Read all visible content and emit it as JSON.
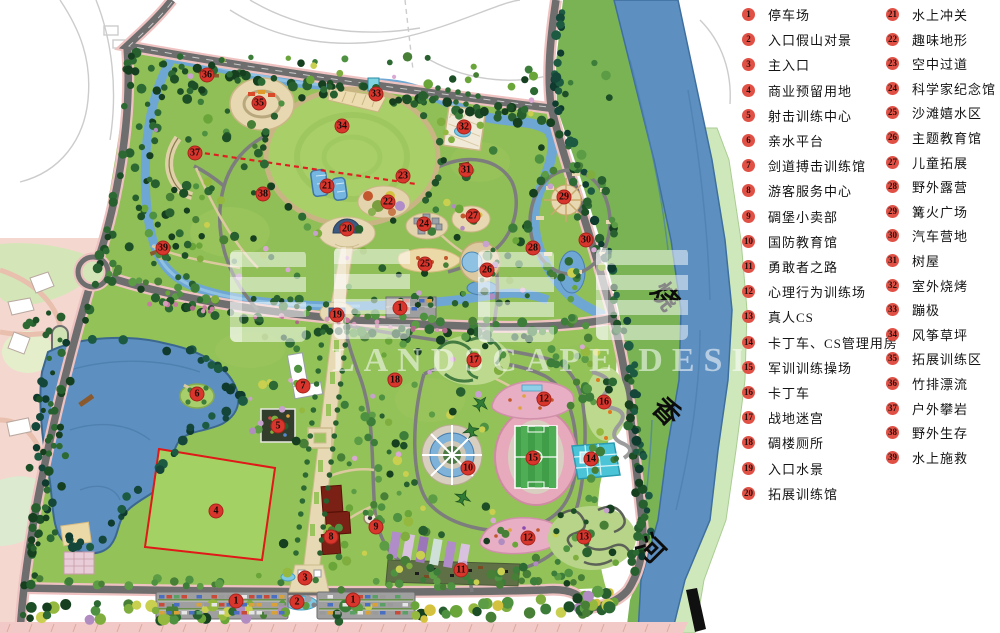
{
  "palette": {
    "river_blue": "#5d8fc0",
    "park_green": "#8fbf56",
    "road_gray": "#6e6e6e",
    "road_edge_pink": "#eec2c0",
    "marker_red": "#d8352c",
    "legend_circle_red": "#e05045",
    "reserve_outline_red": "#e01818",
    "track_pink": "#e7a9bc",
    "outside_pink": "#f4d7cf"
  },
  "watermark": {
    "en": "LANDSCAPE DESIGN"
  },
  "map": {
    "river_name": "烧香河",
    "river_label_chars": [
      "烧",
      "香",
      "河"
    ],
    "markers": [
      {
        "n": "1",
        "x": 400,
        "y": 308
      },
      {
        "n": "1",
        "x": 236,
        "y": 601
      },
      {
        "n": "1",
        "x": 353,
        "y": 600
      },
      {
        "n": "2",
        "x": 297,
        "y": 602
      },
      {
        "n": "3",
        "x": 305,
        "y": 578
      },
      {
        "n": "4",
        "x": 216,
        "y": 511
      },
      {
        "n": "5",
        "x": 278,
        "y": 426
      },
      {
        "n": "6",
        "x": 197,
        "y": 394
      },
      {
        "n": "7",
        "x": 303,
        "y": 386
      },
      {
        "n": "8",
        "x": 331,
        "y": 537
      },
      {
        "n": "9",
        "x": 376,
        "y": 527
      },
      {
        "n": "10",
        "x": 468,
        "y": 468
      },
      {
        "n": "11",
        "x": 461,
        "y": 570
      },
      {
        "n": "12",
        "x": 544,
        "y": 399
      },
      {
        "n": "12",
        "x": 528,
        "y": 538
      },
      {
        "n": "13",
        "x": 584,
        "y": 537
      },
      {
        "n": "14",
        "x": 591,
        "y": 459
      },
      {
        "n": "15",
        "x": 533,
        "y": 458
      },
      {
        "n": "16",
        "x": 604,
        "y": 402
      },
      {
        "n": "17",
        "x": 474,
        "y": 360
      },
      {
        "n": "18",
        "x": 395,
        "y": 380
      },
      {
        "n": "19",
        "x": 337,
        "y": 315
      },
      {
        "n": "20",
        "x": 347,
        "y": 229
      },
      {
        "n": "21",
        "x": 327,
        "y": 186
      },
      {
        "n": "22",
        "x": 388,
        "y": 202
      },
      {
        "n": "23",
        "x": 403,
        "y": 176
      },
      {
        "n": "24",
        "x": 424,
        "y": 224
      },
      {
        "n": "25",
        "x": 425,
        "y": 264
      },
      {
        "n": "26",
        "x": 487,
        "y": 270
      },
      {
        "n": "27",
        "x": 473,
        "y": 216
      },
      {
        "n": "28",
        "x": 533,
        "y": 248
      },
      {
        "n": "29",
        "x": 564,
        "y": 197
      },
      {
        "n": "30",
        "x": 586,
        "y": 240
      },
      {
        "n": "31",
        "x": 466,
        "y": 170
      },
      {
        "n": "32",
        "x": 464,
        "y": 127
      },
      {
        "n": "33",
        "x": 376,
        "y": 94
      },
      {
        "n": "34",
        "x": 342,
        "y": 126
      },
      {
        "n": "35",
        "x": 259,
        "y": 103
      },
      {
        "n": "36",
        "x": 207,
        "y": 75
      },
      {
        "n": "37",
        "x": 195,
        "y": 153
      },
      {
        "n": "38",
        "x": 263,
        "y": 194
      },
      {
        "n": "39",
        "x": 163,
        "y": 248
      }
    ]
  },
  "legend": {
    "items": [
      {
        "n": "1",
        "label": "停车场"
      },
      {
        "n": "2",
        "label": "入口假山对景"
      },
      {
        "n": "3",
        "label": "主入口"
      },
      {
        "n": "4",
        "label": "商业预留用地"
      },
      {
        "n": "5",
        "label": "射击训练中心"
      },
      {
        "n": "6",
        "label": "亲水平台"
      },
      {
        "n": "7",
        "label": "剑道搏击训练馆"
      },
      {
        "n": "8",
        "label": "游客服务中心"
      },
      {
        "n": "9",
        "label": "碉堡小卖部"
      },
      {
        "n": "10",
        "label": "国防教育馆"
      },
      {
        "n": "11",
        "label": "勇敢者之路"
      },
      {
        "n": "12",
        "label": "心理行为训练场"
      },
      {
        "n": "13",
        "label": "真人CS"
      },
      {
        "n": "14",
        "label": "卡丁车、CS管理用房"
      },
      {
        "n": "15",
        "label": "军训训练操场"
      },
      {
        "n": "16",
        "label": "卡丁车"
      },
      {
        "n": "17",
        "label": "战地迷宫"
      },
      {
        "n": "18",
        "label": "碉楼厕所"
      },
      {
        "n": "19",
        "label": "入口水景"
      },
      {
        "n": "20",
        "label": "拓展训练馆"
      },
      {
        "n": "21",
        "label": "水上冲关"
      },
      {
        "n": "22",
        "label": "趣味地形"
      },
      {
        "n": "23",
        "label": "空中过道"
      },
      {
        "n": "24",
        "label": "科学家纪念馆"
      },
      {
        "n": "25",
        "label": "沙滩嬉水区"
      },
      {
        "n": "26",
        "label": "主题教育馆"
      },
      {
        "n": "27",
        "label": "儿童拓展"
      },
      {
        "n": "28",
        "label": "野外露营"
      },
      {
        "n": "29",
        "label": "篝火广场"
      },
      {
        "n": "30",
        "label": "汽车营地"
      },
      {
        "n": "31",
        "label": "树屋"
      },
      {
        "n": "32",
        "label": "室外烧烤"
      },
      {
        "n": "33",
        "label": "蹦极"
      },
      {
        "n": "34",
        "label": "风筝草坪"
      },
      {
        "n": "35",
        "label": "拓展训练区"
      },
      {
        "n": "36",
        "label": "竹排漂流"
      },
      {
        "n": "37",
        "label": "户外攀岩"
      },
      {
        "n": "38",
        "label": "野外生存"
      },
      {
        "n": "39",
        "label": "水上施救"
      }
    ]
  }
}
